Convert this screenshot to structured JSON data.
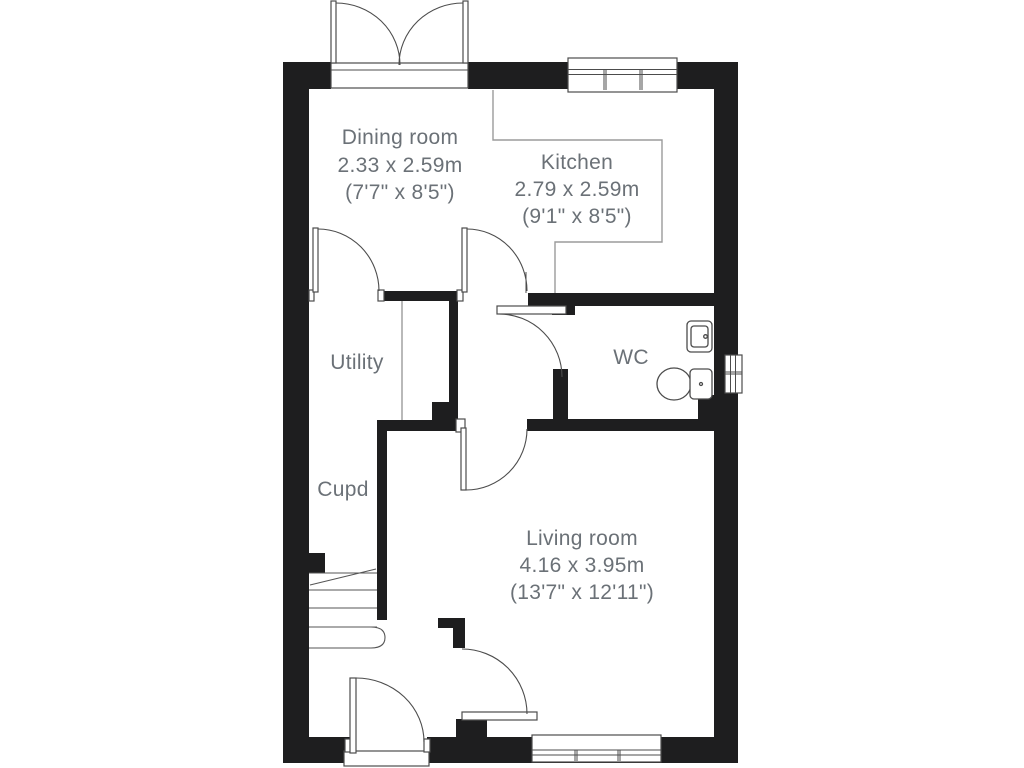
{
  "floorplan": {
    "rooms": [
      {
        "name": "Dining room",
        "metric": "2.33 x 2.59m",
        "imperial": "(7'7\" x 8'5\")"
      },
      {
        "name": "Kitchen",
        "metric": "2.79 x 2.59m",
        "imperial": "(9'1\" x 8'5\")"
      },
      {
        "name": "Utility",
        "metric": "",
        "imperial": ""
      },
      {
        "name": "WC",
        "metric": "",
        "imperial": ""
      },
      {
        "name": "Cupd",
        "metric": "",
        "imperial": ""
      },
      {
        "name": "Living room",
        "metric": "4.16 x 3.95m",
        "imperial": "(13'7\" x 12'11\")"
      }
    ],
    "icons": [
      "french-door-icon",
      "window-icon",
      "door-swing-icon",
      "stairs-icon",
      "toilet-icon",
      "sink-icon"
    ],
    "colors": {
      "wall": "#1e1e1f",
      "line": "#4c4c4c",
      "divider": "#9b9b9b",
      "text": "#6b7177",
      "background": "#ffffff"
    }
  }
}
